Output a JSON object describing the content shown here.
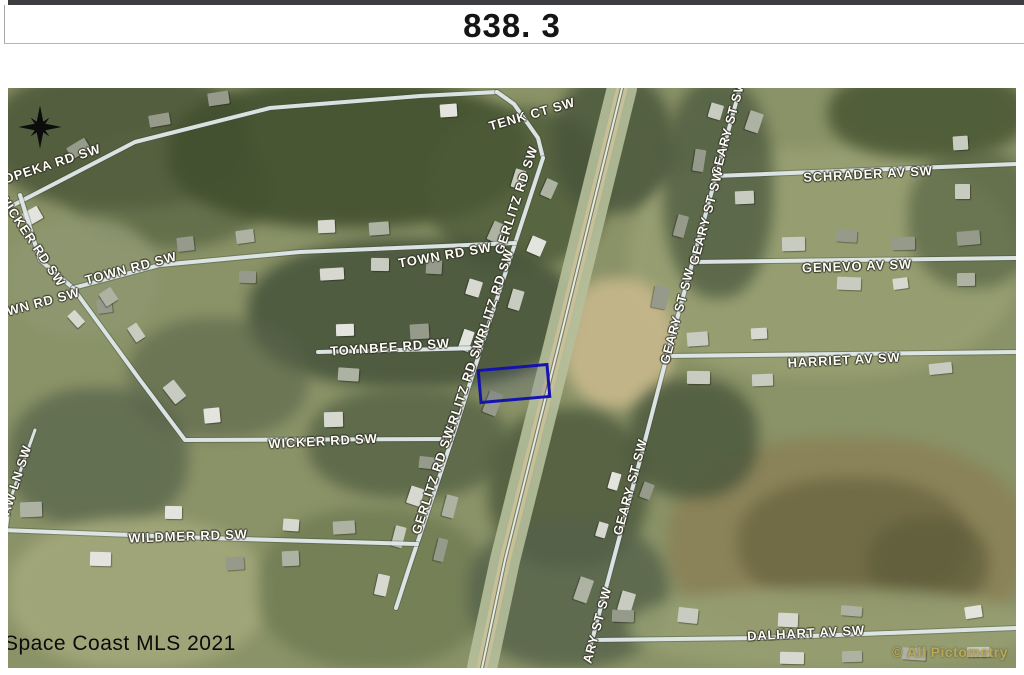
{
  "header": {
    "title": "838. 3"
  },
  "watermarks": {
    "mls": "Space Coast MLS 2021",
    "pictometry": "© All Pictometry"
  },
  "colors": {
    "parcel_outline": "#1414ad",
    "road": "#e0e8ea",
    "road_shadow": "rgba(60,70,50,0.35)",
    "canal_strip": "#b6bf9b",
    "canal_track": "#cbc19a",
    "canal_line": "#e9efef",
    "label_fill": "#fdfdf2",
    "pictometry_text": "#b9a75a"
  },
  "map": {
    "labels": [
      {
        "text": "TOPEKA RD SW",
        "x": 40,
        "y": 77,
        "rot": -18
      },
      {
        "text": "WICKER RD SW",
        "x": 24,
        "y": 152,
        "rot": 56
      },
      {
        "text": "TENK CT SW",
        "x": 524,
        "y": 26,
        "rot": -16
      },
      {
        "text": "TOWN RD SW",
        "x": 123,
        "y": 180,
        "rot": -15
      },
      {
        "text": "OWN RD SW",
        "x": 30,
        "y": 215,
        "rot": -15
      },
      {
        "text": "TOWN RD SW",
        "x": 437,
        "y": 167,
        "rot": -10
      },
      {
        "text": "GERLITZ RD SW",
        "x": 508,
        "y": 112,
        "rot": -72
      },
      {
        "text": "GERLITZ RD SW",
        "x": 484,
        "y": 215,
        "rot": -72
      },
      {
        "text": "GERLITZ RD SW",
        "x": 455,
        "y": 302,
        "rot": -72
      },
      {
        "text": "GERLITZ RD SW",
        "x": 425,
        "y": 392,
        "rot": -72
      },
      {
        "text": "TOYNBEE RD SW",
        "x": 382,
        "y": 259,
        "rot": -4
      },
      {
        "text": "WICKER RD SW",
        "x": 315,
        "y": 353,
        "rot": -3
      },
      {
        "text": "WILDMER RD SW",
        "x": 180,
        "y": 448,
        "rot": -2
      },
      {
        "text": "AW LN SW",
        "x": 8,
        "y": 392,
        "rot": -72
      },
      {
        "text": "GEARY ST SW",
        "x": 720,
        "y": 40,
        "rot": -75
      },
      {
        "text": "GEARY ST SW",
        "x": 698,
        "y": 129,
        "rot": -75
      },
      {
        "text": "GEARY ST SW",
        "x": 669,
        "y": 228,
        "rot": -75
      },
      {
        "text": "GEARY ST SW",
        "x": 622,
        "y": 399,
        "rot": -75
      },
      {
        "text": "ARY ST SW",
        "x": 589,
        "y": 537,
        "rot": -75
      },
      {
        "text": "SCHRADER AV SW",
        "x": 860,
        "y": 86,
        "rot": -3
      },
      {
        "text": "GENEVO AV SW",
        "x": 849,
        "y": 178,
        "rot": -2
      },
      {
        "text": "HARRIET AV SW",
        "x": 836,
        "y": 272,
        "rot": -3
      },
      {
        "text": "DALHART AV SW",
        "x": 798,
        "y": 545,
        "rot": -3
      }
    ],
    "roads": [
      {
        "name": "topeka-rd",
        "points": [
          [
            -8,
            124
          ],
          [
            127,
            54
          ],
          [
            262,
            20
          ],
          [
            412,
            8
          ],
          [
            489,
            4
          ]
        ],
        "w": 4
      },
      {
        "name": "tenk-ct",
        "points": [
          [
            489,
            4
          ],
          [
            506,
            16
          ],
          [
            530,
            50
          ],
          [
            535,
            70
          ]
        ],
        "w": 4
      },
      {
        "name": "gerlitz-rd",
        "points": [
          [
            535,
            70
          ],
          [
            482,
            232
          ],
          [
            447,
            342
          ],
          [
            402,
            477
          ],
          [
            388,
            520
          ]
        ],
        "w": 4
      },
      {
        "name": "wicker-rd-upper",
        "points": [
          [
            12,
            107
          ],
          [
            32,
            172
          ],
          [
            65,
            200
          ]
        ],
        "w": 4
      },
      {
        "name": "town-rd",
        "points": [
          [
            65,
            200
          ],
          [
            152,
            177
          ],
          [
            292,
            164
          ],
          [
            507,
            155
          ]
        ],
        "w": 4
      },
      {
        "name": "wicker-rd",
        "points": [
          [
            65,
            200
          ],
          [
            132,
            292
          ],
          [
            177,
            352
          ],
          [
            444,
            351
          ]
        ],
        "w": 4
      },
      {
        "name": "lane",
        "points": [
          [
            27,
            342
          ],
          [
            2,
            412
          ],
          [
            -3,
            452
          ]
        ],
        "w": 3
      },
      {
        "name": "toynbee-rd",
        "points": [
          [
            310,
            264
          ],
          [
            473,
            260
          ]
        ],
        "w": 4
      },
      {
        "name": "wildmer-rd",
        "points": [
          [
            -8,
            442
          ],
          [
            200,
            450
          ],
          [
            409,
            456
          ]
        ],
        "w": 4
      },
      {
        "name": "geary-st",
        "points": [
          [
            732,
            0
          ],
          [
            660,
            264
          ],
          [
            632,
            372
          ],
          [
            582,
            560
          ]
        ],
        "w": 4
      },
      {
        "name": "schrader-av",
        "points": [
          [
            707,
            88
          ],
          [
            1008,
            76
          ]
        ],
        "w": 4
      },
      {
        "name": "genevo-av",
        "points": [
          [
            685,
            174
          ],
          [
            1008,
            170
          ]
        ],
        "w": 4
      },
      {
        "name": "harriet-av",
        "points": [
          [
            660,
            268
          ],
          [
            1008,
            264
          ]
        ],
        "w": 4
      },
      {
        "name": "dalhart-av",
        "points": [
          [
            585,
            552
          ],
          [
            752,
            550
          ],
          [
            1008,
            540
          ]
        ],
        "w": 4
      }
    ],
    "canal": {
      "points": [
        [
          614,
          0
        ],
        [
          552,
          252
        ],
        [
          497,
          472
        ],
        [
          474,
          580
        ]
      ]
    },
    "parcel": {
      "x": 470,
      "y": 278,
      "w": 66,
      "h": 29,
      "rot": -5
    },
    "compass": {
      "x": 32,
      "y": 39
    }
  }
}
